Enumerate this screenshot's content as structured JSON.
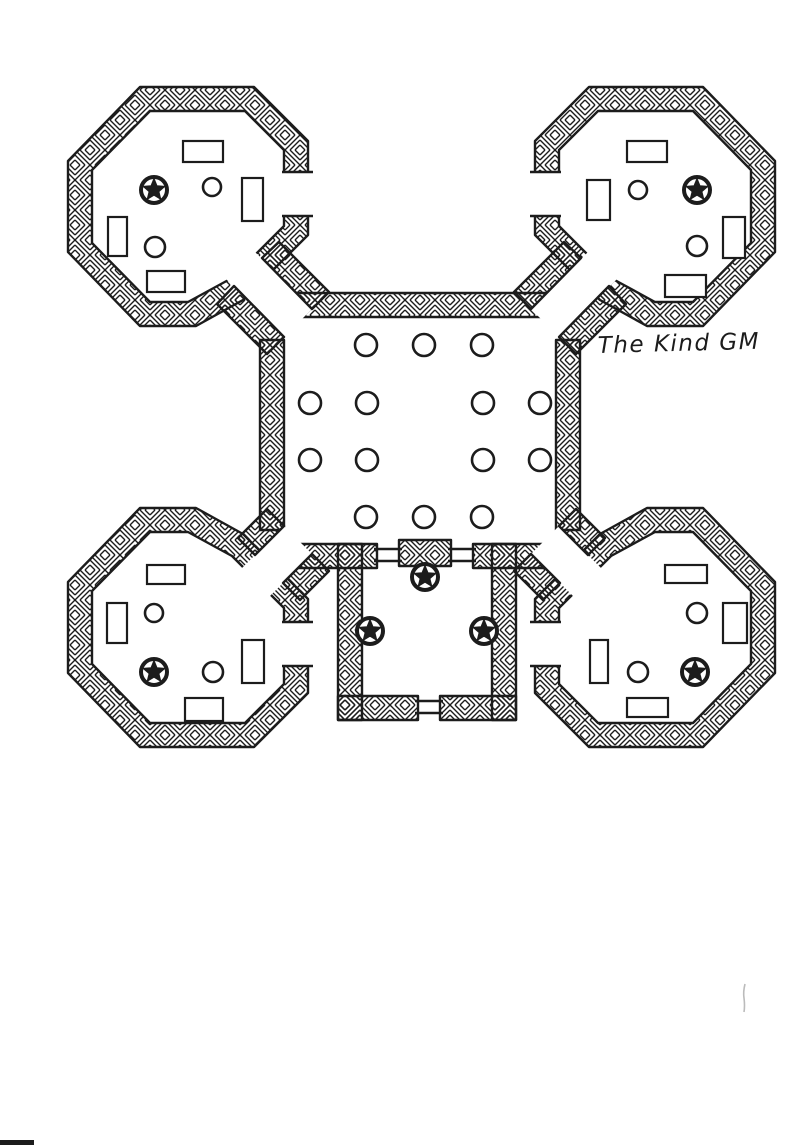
{
  "page": {
    "kind": "hand-drawn dungeon floor plan",
    "paper_color": "#ffffff",
    "ink_color": "#1c1c1c",
    "artifact_color": "#bbbbbb"
  },
  "signature": {
    "text": "The Kind GM"
  },
  "map": {
    "hall": {
      "pillar_radius": 11,
      "pillars": [
        [
          366,
          345
        ],
        [
          424,
          345
        ],
        [
          482,
          345
        ],
        [
          310,
          403
        ],
        [
          367,
          403
        ],
        [
          483,
          403
        ],
        [
          540,
          403
        ],
        [
          310,
          460
        ],
        [
          367,
          460
        ],
        [
          483,
          460
        ],
        [
          540,
          460
        ],
        [
          366,
          517
        ],
        [
          424,
          517
        ],
        [
          482,
          517
        ]
      ]
    },
    "star_pillars": {
      "radius": 13,
      "positions": [
        [
          154,
          190
        ],
        [
          697,
          190
        ],
        [
          154,
          672
        ],
        [
          695,
          672
        ],
        [
          425,
          577
        ],
        [
          370,
          631
        ],
        [
          484,
          631
        ]
      ]
    },
    "room_circles": [
      [
        212,
        187,
        9
      ],
      [
        155,
        247,
        10
      ],
      [
        638,
        190,
        9
      ],
      [
        697,
        246,
        10
      ],
      [
        154,
        613,
        9
      ],
      [
        213,
        672,
        10
      ],
      [
        697,
        613,
        10
      ],
      [
        638,
        672,
        10
      ]
    ],
    "furniture": [
      [
        183,
        141,
        40,
        21
      ],
      [
        242,
        178,
        21,
        43
      ],
      [
        108,
        217,
        19,
        39
      ],
      [
        147,
        271,
        38,
        21
      ],
      [
        627,
        141,
        40,
        21
      ],
      [
        587,
        180,
        23,
        40
      ],
      [
        723,
        217,
        22,
        41
      ],
      [
        665,
        275,
        41,
        22
      ],
      [
        147,
        565,
        38,
        19
      ],
      [
        107,
        603,
        20,
        40
      ],
      [
        242,
        640,
        22,
        43
      ],
      [
        185,
        698,
        38,
        23
      ],
      [
        665,
        565,
        42,
        18
      ],
      [
        723,
        603,
        24,
        40
      ],
      [
        590,
        640,
        18,
        43
      ],
      [
        627,
        698,
        41,
        19
      ]
    ],
    "doors": [
      {
        "x1": 374,
        "x2": 402,
        "y": 555
      },
      {
        "x1": 448,
        "x2": 476,
        "y": 555
      },
      {
        "x1": 415,
        "x2": 443,
        "y": 707
      }
    ]
  }
}
